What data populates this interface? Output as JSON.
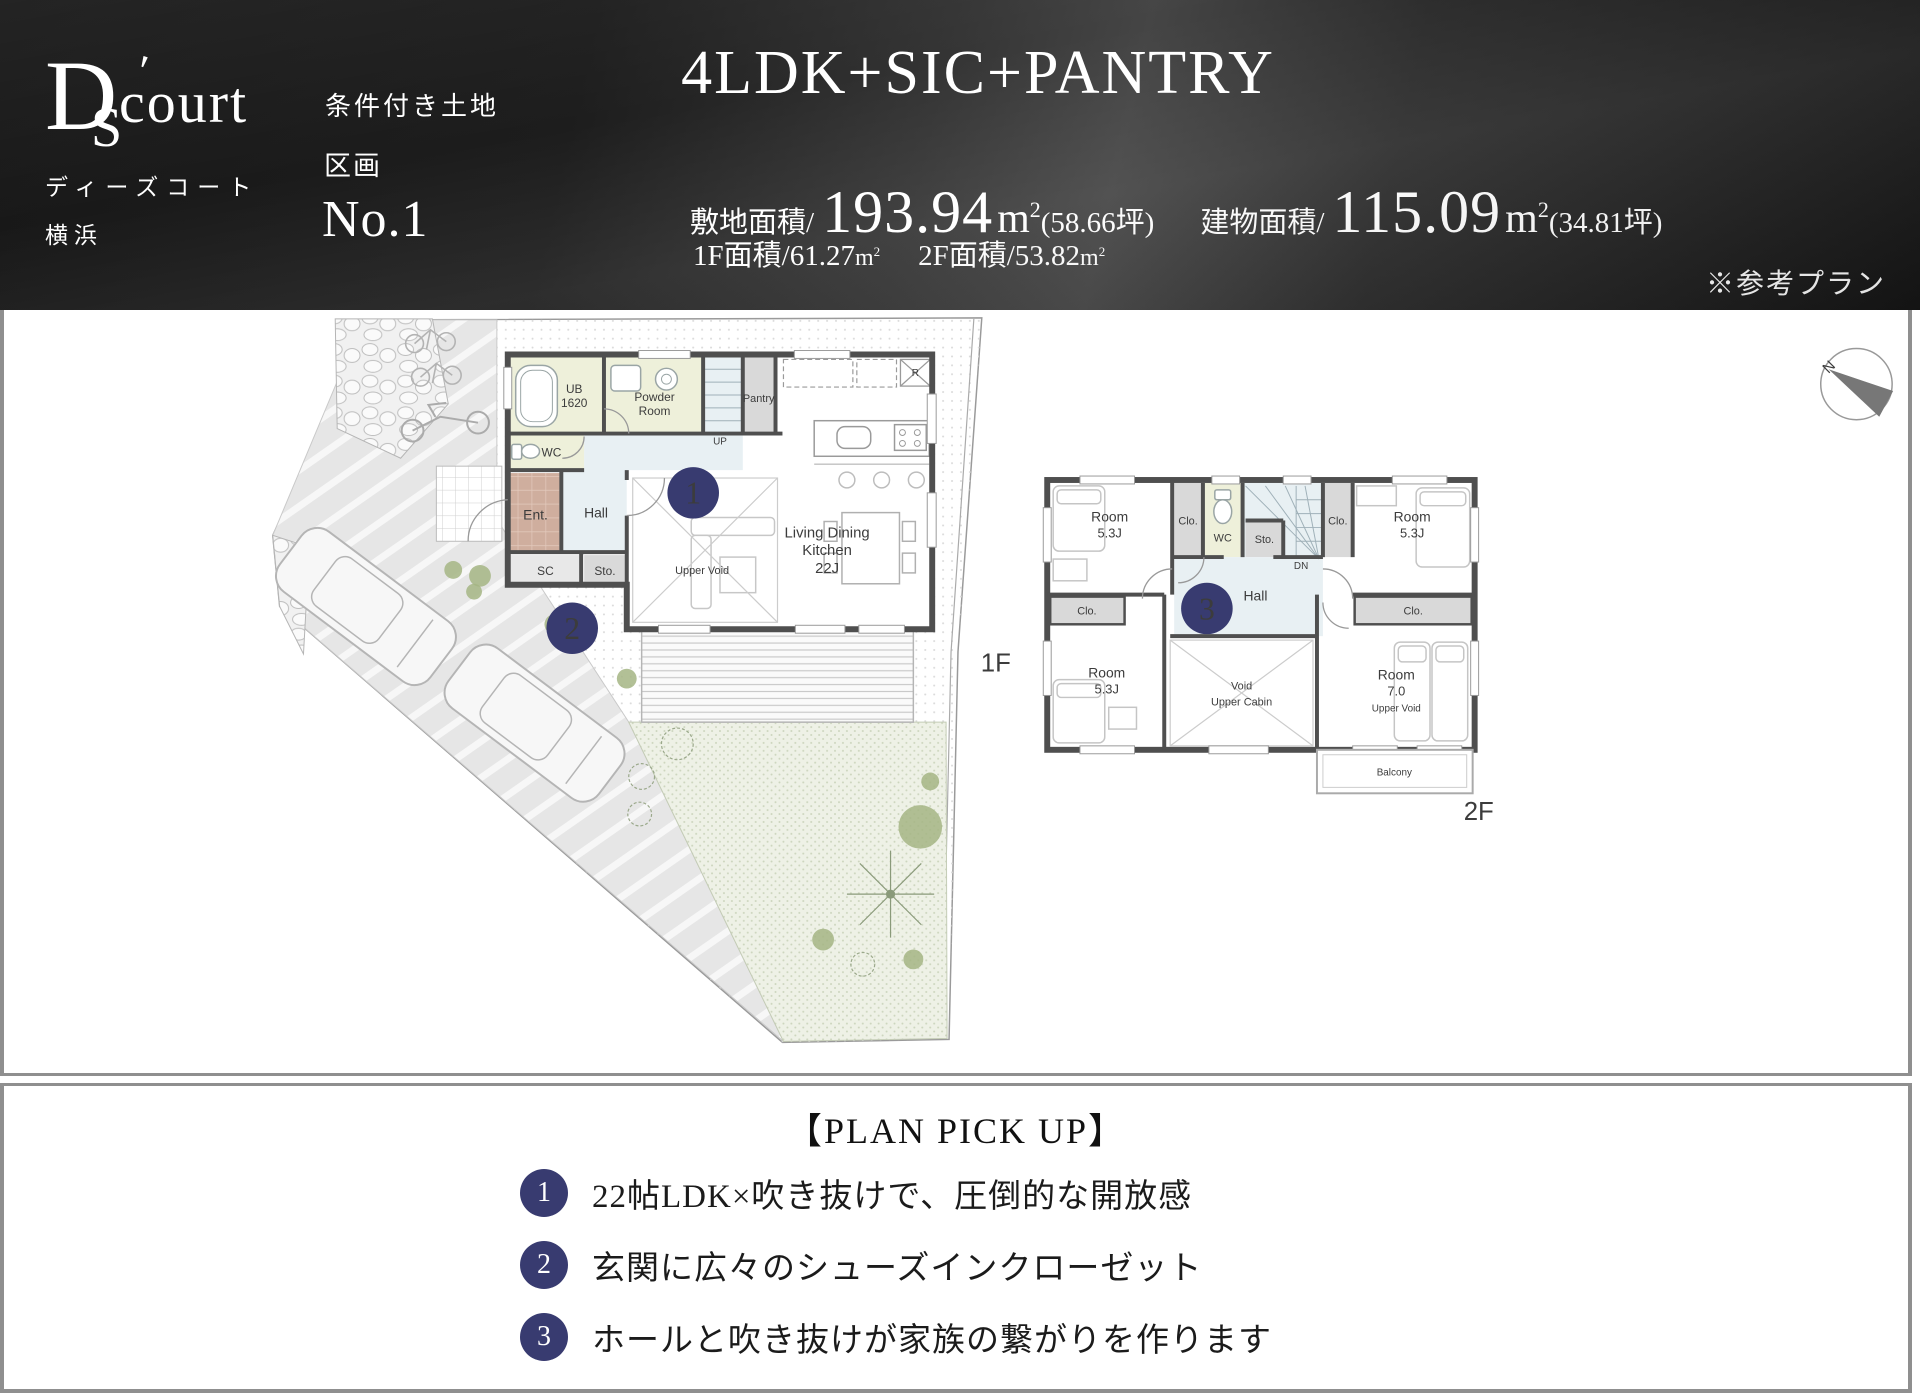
{
  "header": {
    "logo": {
      "d": "D",
      "s": "S",
      "accent": "'",
      "rest": "court",
      "kana": "ディーズコート",
      "city": "横浜"
    },
    "condition": "条件付き土地",
    "lot_label": "区画",
    "lot_no": "No.1",
    "title": "4LDK+SIC+PANTRY",
    "site_area_label": "敷地面積/",
    "site_area_value": "193.94",
    "unit_m": "m",
    "unit_sup": "2",
    "site_area_tsubo": "(58.66坪)",
    "building_area_label": "建物面積/",
    "building_area_value": "115.09",
    "building_area_tsubo": "(34.81坪)",
    "f1_label": "1F面積/",
    "f1_value": "61.27",
    "f2_label": "2F面積/",
    "f2_value": "53.82",
    "note": "※参考プラン"
  },
  "plan1f": {
    "floor_label": "1F",
    "marker1": "1",
    "marker2": "2",
    "rooms": {
      "ub_l1": "UB",
      "ub_l2": "1620",
      "powder_l1": "Powder",
      "powder_l2": "Room",
      "pantry": "Pantry",
      "up": "UP",
      "wc": "WC",
      "ent": "Ent.",
      "hall": "Hall",
      "sc": "SC",
      "sto": "Sto.",
      "upper_void": "Upper Void",
      "ldk_l1": "Living Dining",
      "ldk_l2": "Kitchen",
      "ldk_l3": "22J",
      "fridge": "R"
    }
  },
  "plan2f": {
    "floor_label": "2F",
    "marker3": "3",
    "rooms": {
      "room_tl_l1": "Room",
      "room_tl_l2": "5.3J",
      "clo_top_left": "Clo.",
      "wc": "WC",
      "sto": "Sto.",
      "dn": "DN",
      "clo_top_right": "Clo.",
      "room_tr_l1": "Room",
      "room_tr_l2": "5.3J",
      "hall": "Hall",
      "clo_mid_left": "Clo.",
      "clo_mid_right": "Clo.",
      "room_bl_l1": "Room",
      "room_bl_l2": "5.3J",
      "void_l1": "Void",
      "void_l2": "Upper Cabin",
      "room_br_l1": "Room",
      "room_br_l2": "7.0",
      "room_br_l3": "Upper Void",
      "balcony": "Balcony"
    }
  },
  "compass": {
    "north": "N"
  },
  "pickup": {
    "title": "【PLAN PICK UP】",
    "items": [
      {
        "num": "1",
        "text": "22帖LDK×吹き抜けで、圧倒的な開放感"
      },
      {
        "num": "2",
        "text": "玄関に広々のシューズインクローゼット"
      },
      {
        "num": "3",
        "text": "ホールと吹き抜けが家族の繋がりを作ります"
      }
    ]
  },
  "colors": {
    "accent": "#383b70",
    "wall": "#4f4f4f",
    "bath": "#eef0da",
    "hallfill": "#e8f0f3",
    "closet": "#d9d9d9",
    "entrance": "#cfae9e",
    "tree": "#a5b584",
    "garden": "#eef1e6"
  }
}
